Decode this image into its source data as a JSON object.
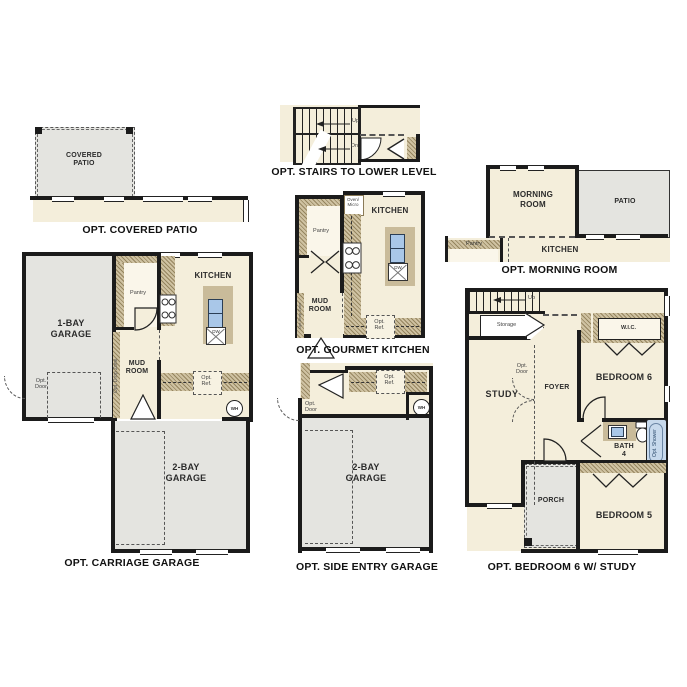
{
  "document": {
    "kind": "floor-plan-options-sheet"
  },
  "colors": {
    "floor": "#f4eedb",
    "concrete": "#e4e4e0",
    "cabinet_tan": "#c9bb9a",
    "wall": "#1b1b1b",
    "fixture_blue": "#a9c7e8",
    "text": "#2b2b2b"
  },
  "panels": {
    "covered_patio": {
      "title": "OPT. COVERED PATIO",
      "room": "COVERED\nPATIO"
    },
    "stairs_lower": {
      "title": "OPT. STAIRS TO LOWER LEVEL",
      "up": "Up",
      "dn": "Dn"
    },
    "morning_room": {
      "title": "OPT. MORNING ROOM",
      "morning": "MORNING\nROOM",
      "patio": "PATIO",
      "kitchen": "KITCHEN",
      "pantry": "Pantry"
    },
    "carriage_garage": {
      "title": "OPT. CARRIAGE GARAGE",
      "garage_1bay": "1-BAY\nGARAGE",
      "garage_2bay": "2-BAY\nGARAGE",
      "kitchen": "KITCHEN",
      "pantry": "Pantry",
      "mud_room": "MUD\nROOM",
      "opt_door": "Opt.\nDoor",
      "opt_ref": "Opt.\nRef.",
      "drop_zone": "Opt. Drop Zone",
      "wh": "WH",
      "dw": "DW"
    },
    "gourmet_kitchen": {
      "title": "OPT. GOURMET KITCHEN",
      "kitchen": "KITCHEN",
      "pantry": "Pantry",
      "mud_room": "MUD\nROOM",
      "oven_micro": "Oven/\nMicro",
      "opt_ref": "Opt.\nRef.",
      "drop_zone": "Opt Drop Zone",
      "dw": "DW"
    },
    "side_entry_garage": {
      "title": "OPT. SIDE ENTRY GARAGE",
      "garage_2bay": "2-BAY\nGARAGE",
      "opt_door": "Opt.\nDoor",
      "opt_ref": "Opt.\nRef.",
      "wh": "WH"
    },
    "bedroom6_study": {
      "title": "OPT. BEDROOM 6 W/ STUDY",
      "study": "STUDY",
      "foyer": "FOYER",
      "bedroom6": "BEDROOM 6",
      "bedroom5": "BEDROOM 5",
      "bath4": "BATH\n4",
      "wic": "W.I.C.",
      "porch": "PORCH",
      "storage": "Storage",
      "up": "Up",
      "opt_door": "Opt.\nDoor",
      "opt_shower": "Opt.\nShower"
    }
  }
}
